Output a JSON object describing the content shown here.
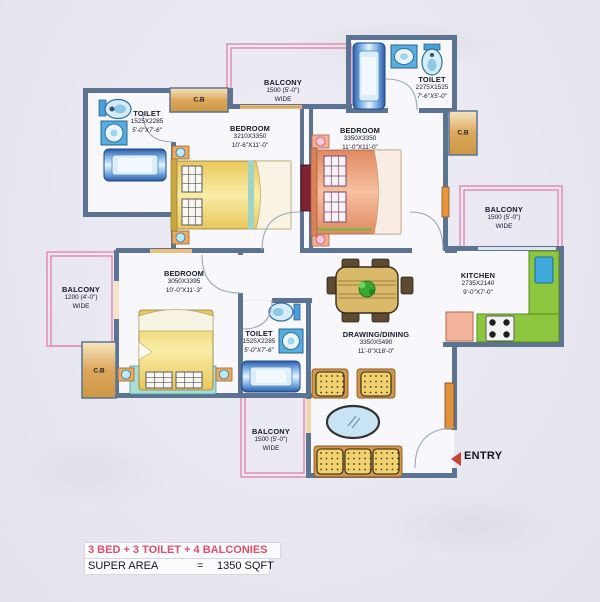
{
  "rooms": {
    "toilet_tl": {
      "name": "TOILET",
      "mm": "1525X2285",
      "ft": "5'-0\"X7'-6\""
    },
    "bedroom_tl": {
      "name": "BEDROOM",
      "mm": "3210X3350",
      "ft": "10'-6\"X11'-0\""
    },
    "toilet_tr": {
      "name": "TOILET",
      "mm": "2275X1525",
      "ft": "7'-6\"X5'-0\""
    },
    "bedroom_tr": {
      "name": "BEDROOM",
      "mm": "3350X3350",
      "ft": "11'-0\"X11'-0\""
    },
    "bedroom_bl": {
      "name": "BEDROOM",
      "mm": "3050X3395",
      "ft": "10'-0\"X11'-3\""
    },
    "toilet_mid": {
      "name": "TOILET",
      "mm": "1525X2285",
      "ft": "5'-0\"X7'-6\""
    },
    "kitchen": {
      "name": "KITCHEN",
      "mm": "2735X2140",
      "ft": "9'-0\"X7'-0\""
    },
    "drawing_dining": {
      "name": "DRAWING/DINING",
      "mm": "3350X5490",
      "ft": "11'-0\"X18'-0\""
    },
    "balcony_top": {
      "name": "BALCONY",
      "size": "1500 (5'-0\")",
      "wide": "WIDE"
    },
    "balcony_right": {
      "name": "BALCONY",
      "size": "1500 (5'-0\")",
      "wide": "WIDE"
    },
    "balcony_left": {
      "name": "BALCONY",
      "size": "1200 (4'-0\")",
      "wide": "WIDE"
    },
    "balcony_bottom": {
      "name": "BALCONY",
      "size": "1500 (5'-0\")",
      "wide": "WIDE"
    }
  },
  "cb_label": "C.B",
  "entry_label": "ENTRY",
  "summary": {
    "title": "3 BED + 3 TOILET + 4 BALCONIES",
    "area_label": "SUPER AREA",
    "equals": "=",
    "area_value": "1350 SQFT"
  },
  "colors": {
    "wall": "#5c7392",
    "balcony_outline": "#e080a8",
    "summary_title_red": "#e04e68",
    "kitchen_counter_green": "#8dc63f",
    "entry_arrow_red": "#c84436",
    "fixture_blue": "#4d9fd8",
    "bed_yellow": "#f3da6e",
    "bed_salmon": "#efa080"
  }
}
